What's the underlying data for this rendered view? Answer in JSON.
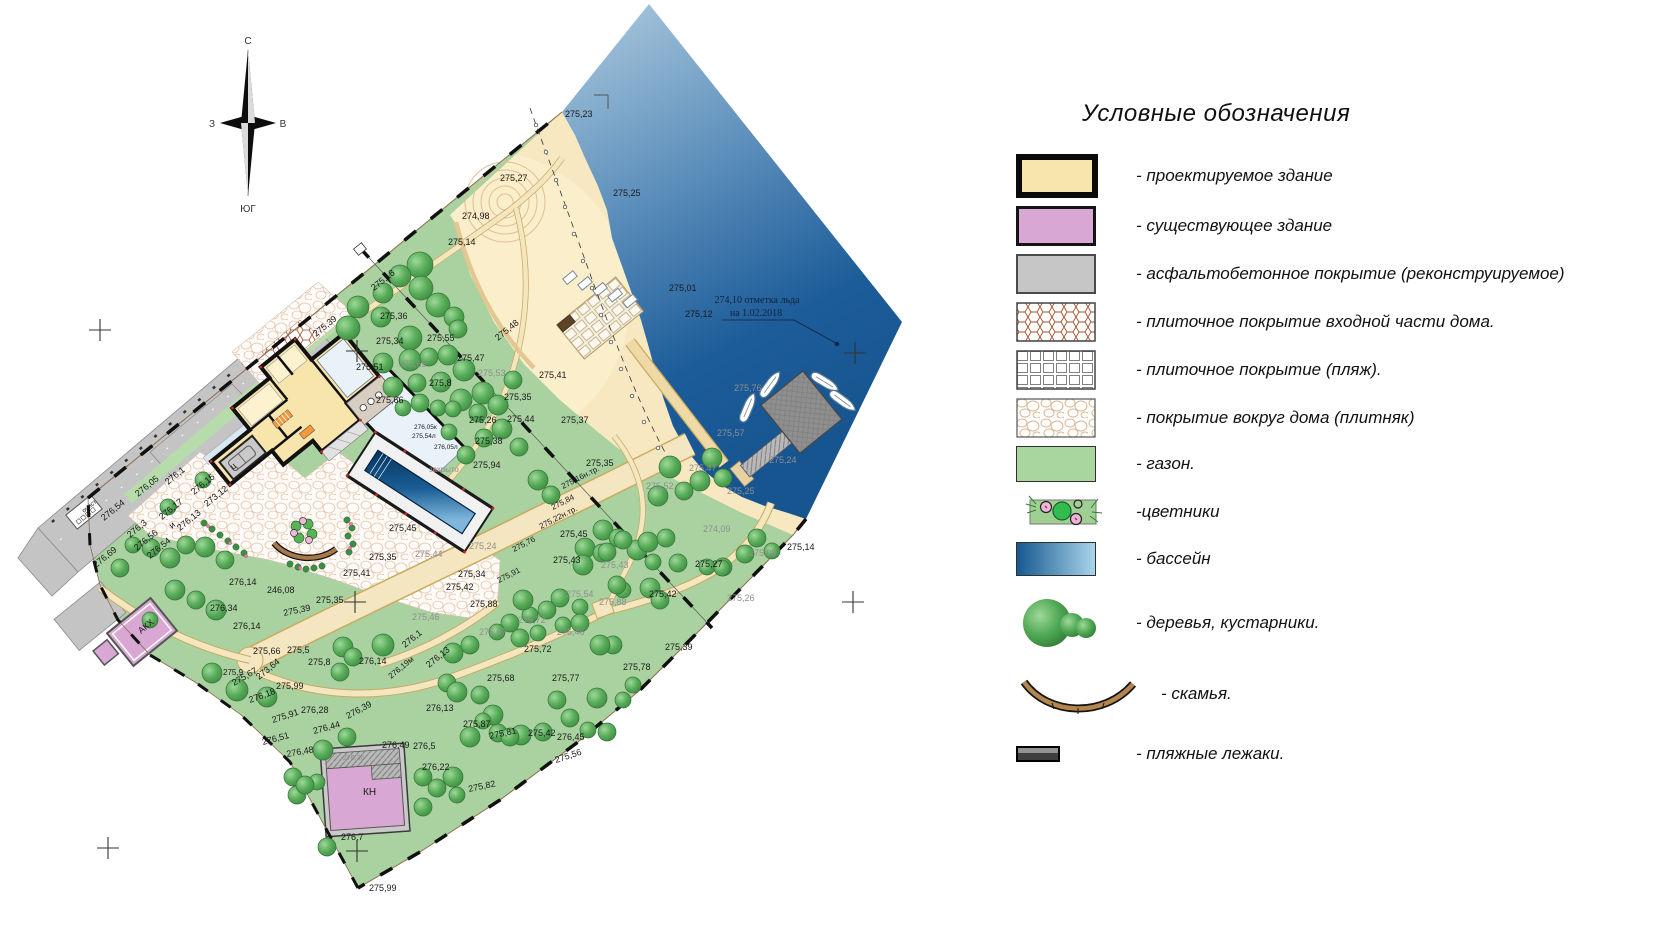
{
  "colors": {
    "lawn": "#A9D2A0",
    "sand": "#F8E8C2",
    "water_top": "#AFCBDF",
    "water_deep": "#1C5C99",
    "new_building": "#F8E5AC",
    "exist_building": "#D9A7D4",
    "asphalt": "#C4C4C4",
    "path": "#F3E6C0",
    "path_edge": "#C9AA5E",
    "pool_dark": "#06345F",
    "pool_light": "#7FB6DC",
    "tree": "#4D9E4F",
    "bench": "#A87848",
    "label": "#1A1A1A",
    "label_gray": "#8F8F8F"
  },
  "compass": {
    "n": "С",
    "e": "В",
    "s": "ЮГ",
    "w": "З"
  },
  "legend": {
    "title": "Условные обозначения",
    "items": [
      {
        "id": "new_building",
        "label": "- проектируемое здание"
      },
      {
        "id": "exist_building",
        "label": "- существующее  здание"
      },
      {
        "id": "asphalt",
        "label": "- асфальтобетонное покрытие (реконструируемое)"
      },
      {
        "id": "tile_entry",
        "label": "- плиточное покрытие входной части дома."
      },
      {
        "id": "tile_beach",
        "label": "- плиточное покрытие (пляж)."
      },
      {
        "id": "stone",
        "label": "-  покрытие вокруг дома (плитняк)"
      },
      {
        "id": "lawn",
        "label": "- газон."
      },
      {
        "id": "flowers",
        "label": "-цветники"
      },
      {
        "id": "pool",
        "label": "- бассейн"
      },
      {
        "id": "trees",
        "label": "- деревья, кустарники.",
        "gap": "gap-lg"
      },
      {
        "id": "bench",
        "label": "- скамья.",
        "gap": "gap-lg"
      },
      {
        "id": "loungers",
        "label": "- пляжные лежаки.",
        "gap": "gap-xl"
      }
    ]
  },
  "map": {
    "ice_note": {
      "line1": "274,10 отметка льда",
      "line2": "на 1.02.2018"
    },
    "labels": [
      [
        "275,23",
        565,
        117
      ],
      [
        "275,27",
        500,
        181
      ],
      [
        "274,98",
        462,
        219
      ],
      [
        "275,14",
        448,
        245
      ],
      [
        "275,25",
        613,
        196
      ],
      [
        "275,01",
        669,
        291
      ],
      [
        "275,12",
        685,
        317
      ],
      [
        "275,18",
        374,
        291,
        -39
      ],
      [
        "275,36",
        380,
        319
      ],
      [
        "275,34",
        376,
        344
      ],
      [
        "275,39",
        316,
        337,
        -39
      ],
      [
        "275,55",
        427,
        341
      ],
      [
        "275,48",
        498,
        341,
        -39
      ],
      [
        "275,47",
        457,
        361
      ],
      [
        "275,65",
        399,
        367,
        0,
        "g"
      ],
      [
        "275,53",
        478,
        376,
        0,
        "g"
      ],
      [
        "275,8",
        429,
        386
      ],
      [
        "275,51",
        356,
        370
      ],
      [
        "275,66",
        376,
        403
      ],
      [
        "275,35",
        504,
        400
      ],
      [
        "275,41",
        539,
        378
      ],
      [
        "275,37",
        561,
        423
      ],
      [
        "275,26",
        469,
        423
      ],
      [
        "275,44",
        507,
        422
      ],
      [
        "275,38",
        475,
        444
      ],
      [
        "275,94",
        473,
        468
      ],
      [
        "276,05к",
        414,
        429,
        0,
        "b",
        6.5
      ],
      [
        "275,54л",
        412,
        438,
        0,
        "b",
        6.5
      ],
      [
        "276,05л",
        434,
        449,
        0,
        "b",
        6.5
      ],
      [
        "закрыто",
        429,
        472,
        0,
        "g",
        8
      ],
      [
        "275,35",
        586,
        466
      ],
      [
        "275,52",
        646,
        489,
        0,
        "g"
      ],
      [
        "275,47",
        689,
        471,
        0,
        "g"
      ],
      [
        "275,25",
        727,
        494,
        0,
        "g"
      ],
      [
        "275,57",
        717,
        436,
        0,
        "g"
      ],
      [
        "275,76",
        734,
        391,
        0,
        "g"
      ],
      [
        "275,24",
        769,
        463,
        0,
        "g"
      ],
      [
        "274,09",
        703,
        532,
        0,
        "g"
      ],
      [
        "275,08",
        749,
        556,
        0,
        "g"
      ],
      [
        "275,14",
        787,
        550
      ],
      [
        "275,26",
        727,
        601,
        0,
        "g"
      ],
      [
        "275,27",
        695,
        567
      ],
      [
        "275,42",
        649,
        597
      ],
      [
        "275,39",
        665,
        650
      ],
      [
        "275,78",
        623,
        670
      ],
      [
        "275,16н.тр.",
        563,
        489,
        -27,
        "b",
        8
      ],
      [
        "275,84",
        553,
        510,
        -27,
        "b",
        8
      ],
      [
        "275,22н.тр.",
        541,
        529,
        -27,
        "b",
        8
      ],
      [
        "275,76",
        514,
        552,
        -27,
        "b",
        8
      ],
      [
        "275,91",
        499,
        583,
        -27,
        "b",
        8
      ],
      [
        "275,45",
        389,
        531
      ],
      [
        "275,35",
        369,
        560
      ],
      [
        "275,41",
        343,
        576
      ],
      [
        "275,35",
        316,
        603
      ],
      [
        "275,39",
        284,
        616,
        -12
      ],
      [
        "275,43",
        553,
        563
      ],
      [
        "275,45",
        560,
        537
      ],
      [
        "275,24",
        469,
        549,
        0,
        "g"
      ],
      [
        "275,44",
        415,
        557,
        0,
        "g"
      ],
      [
        "275,34",
        458,
        577
      ],
      [
        "275,42",
        446,
        590
      ],
      [
        "275,88",
        470,
        607
      ],
      [
        "275,88",
        599,
        605,
        0,
        "g"
      ],
      [
        "275,54",
        566,
        597,
        0,
        "g"
      ],
      [
        "275,43",
        601,
        568,
        0,
        "g"
      ],
      [
        "275,46",
        412,
        620,
        0,
        "g"
      ],
      [
        "275,72",
        518,
        623,
        0,
        "g"
      ],
      [
        "276,46",
        557,
        635,
        0,
        "g"
      ],
      [
        "275,67",
        479,
        635,
        0,
        "g"
      ],
      [
        "275,72",
        524,
        652
      ],
      [
        "275,68",
        487,
        681
      ],
      [
        "275,77",
        552,
        681
      ],
      [
        "276,1",
        405,
        648,
        -39
      ],
      [
        "276,13",
        429,
        668,
        -39
      ],
      [
        "276,19м",
        391,
        679,
        -39,
        "b",
        8
      ],
      [
        "276,13",
        426,
        711
      ],
      [
        "275,87",
        463,
        727
      ],
      [
        "275,81",
        490,
        739,
        -12
      ],
      [
        "275,42",
        528,
        736
      ],
      [
        "276,45",
        557,
        740
      ],
      [
        "275,56",
        556,
        763,
        -18
      ],
      [
        "275,82",
        469,
        792,
        -12
      ],
      [
        "276,22",
        422,
        770
      ],
      [
        "276,49",
        382,
        748
      ],
      [
        "276,5",
        413,
        749
      ],
      [
        "276,36",
        343,
        760,
        0,
        "g",
        7
      ],
      [
        "276,7",
        341,
        840
      ],
      [
        "275,99",
        369,
        891
      ],
      [
        "276,05",
        138,
        497,
        -39
      ],
      [
        "276,1",
        168,
        485,
        -39
      ],
      [
        "276,15",
        194,
        495,
        -39
      ],
      [
        "273,12",
        207,
        507,
        -39
      ],
      [
        "276,17",
        162,
        520,
        -39
      ],
      [
        "276,13",
        180,
        531,
        -39
      ],
      [
        "276,3",
        130,
        538,
        -39
      ],
      [
        "276,56",
        137,
        551,
        -39
      ],
      [
        "276,54",
        150,
        559,
        -39
      ],
      [
        "276,54",
        104,
        521,
        -39
      ],
      [
        "276,69",
        96,
        568,
        -39
      ],
      [
        "276,14",
        229,
        585
      ],
      [
        "276,34",
        210,
        611
      ],
      [
        "276,14",
        233,
        629
      ],
      [
        "246,08",
        267,
        593
      ],
      [
        "275,66",
        253,
        654
      ],
      [
        "275,5",
        287,
        653
      ],
      [
        "275,8",
        308,
        665
      ],
      [
        "276,14",
        359,
        664
      ],
      [
        "275,9",
        223,
        675,
        0,
        "b",
        8
      ],
      [
        "273,64",
        259,
        680,
        -39
      ],
      [
        "275,67",
        234,
        686,
        -30
      ],
      [
        "275,99",
        276,
        689
      ],
      [
        "276,18",
        250,
        703,
        -20
      ],
      [
        "276,28",
        301,
        713
      ],
      [
        "275,91",
        273,
        723,
        -18
      ],
      [
        "276,51",
        263,
        745,
        -15
      ],
      [
        "276,48",
        287,
        757,
        -10
      ],
      [
        "276,44",
        314,
        734,
        -15
      ],
      [
        "276,39",
        348,
        719,
        -28
      ],
      [
        "ц",
        233,
        470,
        -39
      ],
      [
        "и",
        172,
        529,
        -39
      ],
      [
        "очист.",
        84,
        513,
        -39,
        "b",
        6.5
      ],
      [
        "АКХ",
        141,
        634,
        -39,
        "b",
        9
      ],
      [
        "КН",
        363,
        795,
        0,
        "b",
        10
      ]
    ],
    "trees": [
      [
        420,
        265,
        13
      ],
      [
        400,
        276,
        11
      ],
      [
        421,
        288,
        12
      ],
      [
        383,
        293,
        10
      ],
      [
        358,
        307,
        11
      ],
      [
        348,
        328,
        12
      ],
      [
        381,
        317,
        10
      ],
      [
        410,
        338,
        12
      ],
      [
        438,
        305,
        12
      ],
      [
        454,
        317,
        10
      ],
      [
        458,
        329,
        9
      ],
      [
        410,
        360,
        11
      ],
      [
        383,
        363,
        10
      ],
      [
        429,
        357,
        9
      ],
      [
        448,
        355,
        10
      ],
      [
        464,
        370,
        11
      ],
      [
        393,
        387,
        10
      ],
      [
        417,
        383,
        9
      ],
      [
        441,
        382,
        10
      ],
      [
        461,
        400,
        11
      ],
      [
        420,
        403,
        9
      ],
      [
        438,
        408,
        8
      ],
      [
        483,
        393,
        11
      ],
      [
        498,
        405,
        10
      ],
      [
        513,
        380,
        9
      ],
      [
        453,
        409,
        8
      ],
      [
        478,
        413,
        9
      ],
      [
        403,
        408,
        8
      ],
      [
        502,
        429,
        10
      ],
      [
        484,
        438,
        9
      ],
      [
        466,
        455,
        9
      ],
      [
        449,
        432,
        8
      ],
      [
        519,
        447,
        9
      ],
      [
        670,
        467,
        11
      ],
      [
        712,
        458,
        10
      ],
      [
        723,
        478,
        9
      ],
      [
        700,
        481,
        10
      ],
      [
        684,
        491,
        9
      ],
      [
        658,
        496,
        10
      ],
      [
        603,
        530,
        10
      ],
      [
        618,
        538,
        9
      ],
      [
        637,
        550,
        10
      ],
      [
        757,
        538,
        9
      ],
      [
        772,
        551,
        8
      ],
      [
        745,
        554,
        9
      ],
      [
        723,
        567,
        9
      ],
      [
        538,
        480,
        10
      ],
      [
        551,
        495,
        9
      ],
      [
        585,
        548,
        10
      ],
      [
        602,
        553,
        9
      ],
      [
        623,
        540,
        9
      ],
      [
        648,
        542,
        10
      ],
      [
        666,
        538,
        9
      ],
      [
        653,
        562,
        8
      ],
      [
        678,
        563,
        9
      ],
      [
        707,
        567,
        8
      ],
      [
        722,
        568,
        8
      ],
      [
        560,
        598,
        9
      ],
      [
        580,
        607,
        8
      ],
      [
        547,
        610,
        9
      ],
      [
        530,
        615,
        8
      ],
      [
        510,
        623,
        9
      ],
      [
        563,
        625,
        8
      ],
      [
        538,
        633,
        8
      ],
      [
        520,
        638,
        9
      ],
      [
        497,
        632,
        8
      ],
      [
        543,
        732,
        9
      ],
      [
        521,
        735,
        10
      ],
      [
        498,
        733,
        9
      ],
      [
        570,
        718,
        9
      ],
      [
        588,
        730,
        8
      ],
      [
        607,
        732,
        9
      ],
      [
        597,
        698,
        10
      ],
      [
        623,
        700,
        8
      ],
      [
        557,
        700,
        9
      ],
      [
        633,
        685,
        8
      ],
      [
        613,
        645,
        9
      ],
      [
        600,
        645,
        10
      ],
      [
        580,
        623,
        9
      ],
      [
        650,
        588,
        10
      ],
      [
        660,
        600,
        9
      ],
      [
        623,
        590,
        8
      ],
      [
        617,
        585,
        9
      ],
      [
        607,
        552,
        9
      ],
      [
        583,
        565,
        10
      ],
      [
        523,
        600,
        10
      ],
      [
        343,
        647,
        10
      ],
      [
        353,
        657,
        9
      ],
      [
        383,
        645,
        11
      ],
      [
        340,
        672,
        9
      ],
      [
        453,
        653,
        10
      ],
      [
        470,
        645,
        9
      ],
      [
        447,
        683,
        9
      ],
      [
        457,
        692,
        10
      ],
      [
        480,
        695,
        9
      ],
      [
        493,
        715,
        10
      ],
      [
        483,
        721,
        8
      ],
      [
        510,
        737,
        9
      ],
      [
        470,
        737,
        10
      ],
      [
        453,
        777,
        10
      ],
      [
        423,
        777,
        9
      ],
      [
        437,
        788,
        9
      ],
      [
        457,
        795,
        8
      ],
      [
        423,
        807,
        9
      ],
      [
        323,
        750,
        10
      ],
      [
        347,
        737,
        9
      ],
      [
        317,
        782,
        8
      ],
      [
        327,
        847,
        9
      ],
      [
        297,
        795,
        9
      ],
      [
        212,
        673,
        10
      ],
      [
        237,
        690,
        11
      ],
      [
        267,
        697,
        10
      ],
      [
        293,
        777,
        9
      ],
      [
        305,
        785,
        9
      ],
      [
        225,
        560,
        9
      ],
      [
        205,
        547,
        10
      ],
      [
        186,
        545,
        9
      ],
      [
        170,
        558,
        10
      ],
      [
        151,
        548,
        9
      ],
      [
        133,
        545,
        8
      ],
      [
        120,
        568,
        9
      ],
      [
        175,
        590,
        10
      ],
      [
        196,
        600,
        9
      ],
      [
        216,
        610,
        10
      ],
      [
        150,
        620,
        8
      ],
      [
        203,
        480,
        8
      ],
      [
        168,
        507,
        8
      ]
    ],
    "bushes": [
      [
        204,
        523
      ],
      [
        212,
        529
      ],
      [
        220,
        535
      ],
      [
        228,
        541
      ],
      [
        236,
        547
      ],
      [
        244,
        553
      ],
      [
        347,
        520
      ],
      [
        352,
        528
      ],
      [
        348,
        536
      ],
      [
        353,
        544
      ],
      [
        349,
        552
      ],
      [
        290,
        564
      ],
      [
        298,
        567
      ],
      [
        306,
        569
      ],
      [
        314,
        568
      ],
      [
        322,
        566
      ]
    ],
    "flowers": [
      [
        208,
        526
      ],
      [
        230,
        543
      ],
      [
        246,
        556
      ],
      [
        351,
        524
      ],
      [
        350,
        548
      ],
      [
        300,
        568
      ]
    ],
    "crosses": [
      [
        100,
        330
      ],
      [
        357,
        351
      ],
      [
        855,
        353
      ],
      [
        355,
        602
      ],
      [
        853,
        602
      ],
      [
        108,
        848
      ],
      [
        357,
        851
      ]
    ],
    "shore_marks": [
      [
        536,
        125
      ],
      [
        546,
        152
      ],
      [
        556,
        180
      ],
      [
        565,
        207
      ],
      [
        574,
        234
      ],
      [
        583,
        261
      ],
      [
        592,
        288
      ],
      [
        601,
        315
      ],
      [
        611,
        342
      ],
      [
        621,
        369
      ],
      [
        632,
        396
      ],
      [
        644,
        422
      ],
      [
        658,
        448
      ],
      [
        674,
        472
      ]
    ]
  }
}
